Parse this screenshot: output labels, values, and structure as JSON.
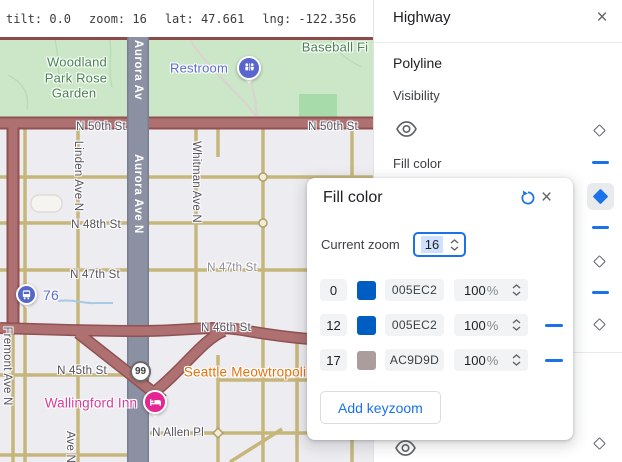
{
  "status_bar": {
    "tilt": "tilt: 0.0",
    "zoom": "zoom: 16",
    "lat": "lat: 47.661",
    "lng": "lng: -122.356"
  },
  "panel": {
    "title": "Highway",
    "close_icon": "×",
    "polyline_section": "Polyline",
    "visibility_label": "Visibility",
    "fill_color_label": "Fill color"
  },
  "dialog": {
    "title": "Fill color",
    "close_icon": "×",
    "current_zoom_label": "Current zoom",
    "current_zoom_value": "16",
    "percent_sign": "%",
    "add_button_label": "Add keyzoom",
    "rows": [
      {
        "zoom": "0",
        "hex": "005EC2",
        "opacity": "100",
        "swatch_style": "background:#005EC2",
        "removable": false
      },
      {
        "zoom": "12",
        "hex": "005EC2",
        "opacity": "100",
        "swatch_style": "background:#005EC2",
        "removable": true
      },
      {
        "zoom": "17",
        "hex": "AC9D9D",
        "opacity": "100",
        "swatch_style": "background:#AC9D9D",
        "removable": true
      }
    ]
  },
  "map": {
    "labels": {
      "park_line1": "Woodland",
      "park_line2": "Park Rose",
      "park_line3": "Garden",
      "restroom": "Restroom",
      "baseball": "Baseball Fi",
      "n50_left": "N 50th St",
      "n50_right": "N 50th St",
      "linden": "Linden Ave N",
      "aurora_top": "Aurora Av",
      "aurora_mid": "Aurora Ave N",
      "whitman": "Whitman Ave N",
      "n48": "N 48th St",
      "n47_left": "N 47th St",
      "n47_right": "N 47th St",
      "bus_route": "76",
      "fremont": "Fremont Ave N",
      "n46": "N 46th St",
      "n45": "N 45th St",
      "shield": "99",
      "cat_cafe": "Seattle Meowtropoli",
      "hotel": "Wallingford Inn",
      "n_allen": "N Allen Pl",
      "ave_n": "Ave N"
    },
    "colors": {
      "highway_fill_zoom16": "#8b91a3",
      "arterial_fill": "#ae7070",
      "park_green": "#cbe7c8",
      "urban_background": "#edecf0",
      "accent_blue": "#1a73e8"
    }
  }
}
